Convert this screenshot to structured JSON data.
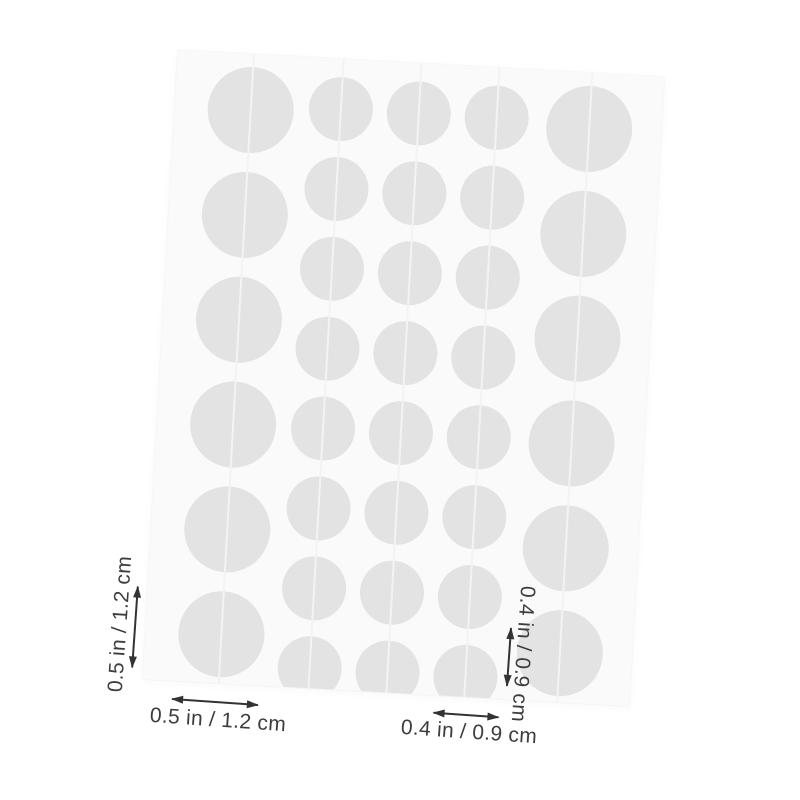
{
  "colors": {
    "page_bg": "#ffffff",
    "sheet_bg": "#fafafa",
    "circle_fill": "#e3e3e4",
    "slit_line": "#f3f3f3",
    "annotation_text": "#3d3d3d",
    "arrow": "#333333"
  },
  "sheet": {
    "rotation_deg": 3.2,
    "columns": [
      {
        "size": "large",
        "x": 76,
        "diameter": 86,
        "rows_y": [
          56,
          161,
          266,
          371,
          476,
          581
        ]
      },
      {
        "size": "small",
        "x": 166,
        "diameter": 64,
        "rows_y": [
          50,
          130,
          210,
          290,
          370,
          450,
          530,
          610
        ]
      },
      {
        "size": "small",
        "x": 244,
        "diameter": 64,
        "rows_y": [
          50,
          130,
          210,
          290,
          370,
          450,
          530,
          610
        ]
      },
      {
        "size": "small",
        "x": 322,
        "diameter": 64,
        "rows_y": [
          50,
          130,
          210,
          290,
          370,
          450,
          530,
          610
        ]
      },
      {
        "size": "large",
        "x": 415,
        "diameter": 86,
        "rows_y": [
          56,
          161,
          266,
          371,
          476,
          581
        ]
      }
    ]
  },
  "annotations": {
    "left_vertical": {
      "label": "0.5 in / 1.2 cm"
    },
    "bottom_left": {
      "label": "0.5 in / 1.2 cm"
    },
    "right_vertical": {
      "label": "0.4 in / 0.9 cm"
    },
    "bottom_right": {
      "label": "0.4 in / 0.9 cm"
    }
  }
}
